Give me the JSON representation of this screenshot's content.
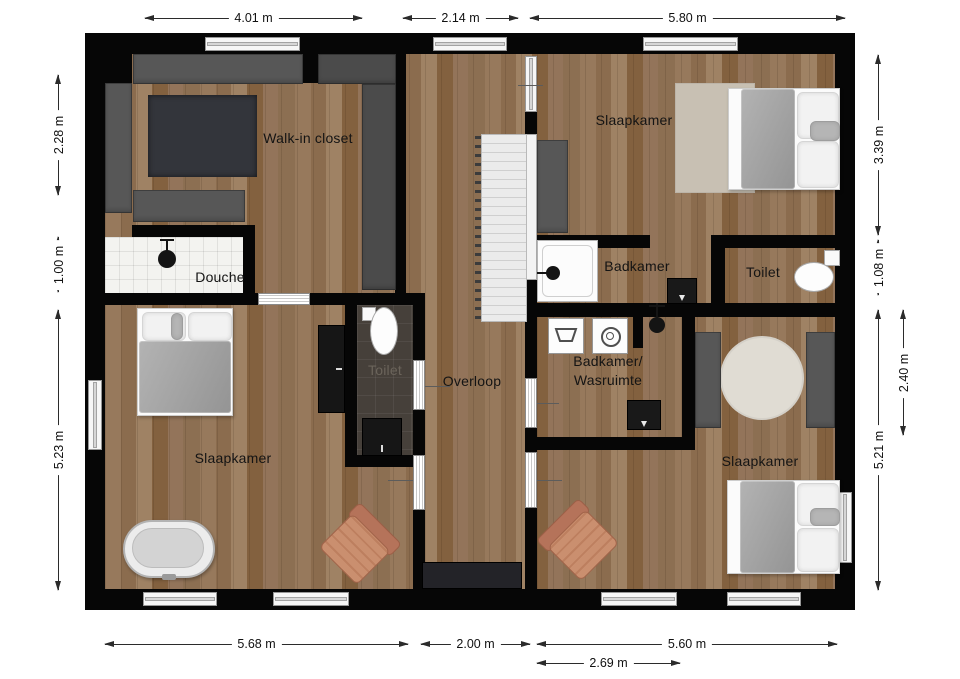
{
  "plan": {
    "type": "floor-plan",
    "rooms": {
      "walk_in_closet": "Walk-in closet",
      "slaapkamer_top_right": "Slaapkamer",
      "douche": "Douche",
      "badkamer": "Badkamer",
      "toilet_right": "Toilet",
      "toilet_middle": "Toilet",
      "overloop": "Overloop",
      "badkamer_wasruimte_line1": "Badkamer/",
      "badkamer_wasruimte_line2": "Wasruimte",
      "slaapkamer_bottom_left": "Slaapkamer",
      "slaapkamer_bottom_right": "Slaapkamer"
    },
    "dimensions": {
      "top": [
        "4.01 m",
        "2.14 m",
        "5.80 m"
      ],
      "bottom": [
        "5.68 m",
        "2.00 m",
        "5.60 m",
        "2.69 m"
      ],
      "left": [
        "2.28 m",
        "1.00 m",
        "5.23 m"
      ],
      "right": [
        "3.39 m",
        "1.08 m",
        "5.21 m",
        "2.40 m"
      ]
    },
    "colors": {
      "wall": "#060606",
      "wood_floor": "#8f7052",
      "cabinet_gray": "#575757",
      "rug_dark": "#33353b",
      "rug_beige": "#c8c0b3",
      "rug_round": "#e0dcd3",
      "shower_tile_white": "#f3f3f0",
      "toilet_tile_dark": "#46403a",
      "duvet_gray": "#a3a3a3",
      "armchair_tan": "#c48a6b",
      "dimension_text": "#111111"
    }
  }
}
